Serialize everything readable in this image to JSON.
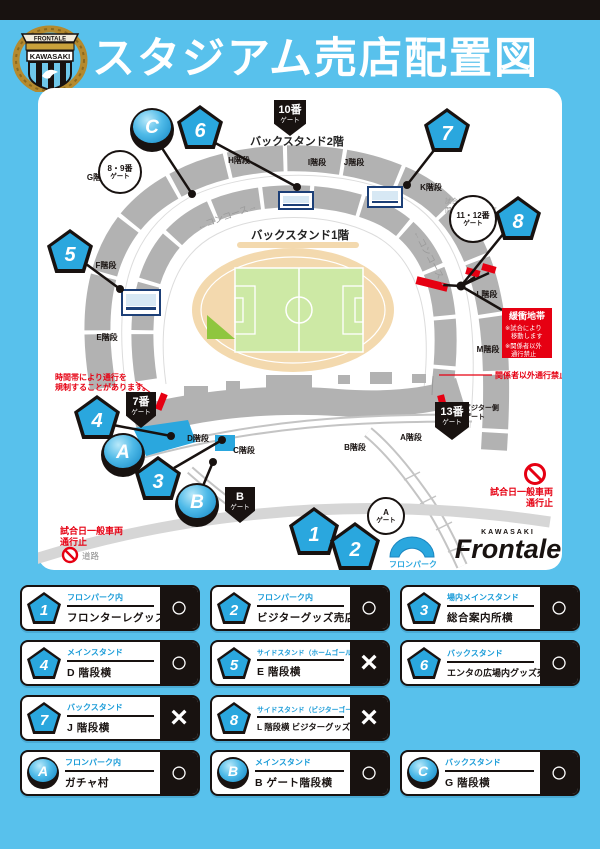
{
  "header": {
    "title": "スタジアム売店配置図",
    "crest": {
      "banner": "FRONTALE",
      "club": "KAWASAKI"
    }
  },
  "map": {
    "stands": {
      "back2f": "バックスタンド2階",
      "back1f": "バックスタンド1階",
      "concourse_left": "←コンコース→",
      "concourse_right": "←コンコース→"
    },
    "sections": {
      "g": "G階段",
      "h": "H階段",
      "i": "I階段",
      "j": "J階段",
      "k": "K階段",
      "f": "F階段",
      "e": "E階段",
      "l": "L階段",
      "m": "M階段",
      "d": "D階段",
      "c": "C階段",
      "b": "B階段",
      "a": "A階段"
    },
    "markers": {
      "p1": "1",
      "p2": "2",
      "p3": "3",
      "p4": "4",
      "p5": "5",
      "p6": "6",
      "p7": "7",
      "p8": "8",
      "a": "A",
      "b": "B",
      "c": "C"
    },
    "gates": {
      "g89": {
        "l1": "8・9番",
        "l2": "ゲート"
      },
      "g10": {
        "l1": "10番",
        "l2": "ゲート"
      },
      "g1112": {
        "l1": "11・12番",
        "l2": "ゲート"
      },
      "g7": {
        "l1": "7番",
        "l2": "ゲート"
      },
      "g13": {
        "l1": "13番",
        "l2": "ゲート"
      },
      "gb": {
        "l1": "B",
        "l2": "ゲート"
      },
      "ga": {
        "l1": "A",
        "l2": "ゲート"
      }
    },
    "visitor_gate": {
      "l1": "ビジター側",
      "l2": "ゲート"
    },
    "buffer": {
      "title": "緩衝地帯",
      "l1": "※試合により",
      "l2": "移動します",
      "l3": "※関係者以外",
      "l4": "通行禁止"
    },
    "notes": {
      "area1": "試合により",
      "area2": "関係者以外エリア",
      "time1": "時間帯により通行を",
      "time2": "規制することがあります。",
      "staff": "関係者以外通行禁止",
      "car1": "試合日一般車両",
      "car2": "通行止",
      "road": "道路"
    },
    "fronpark": "フロンパーク",
    "logo": {
      "kawasaki": "KAWASAKI",
      "frontale": "Frontale"
    }
  },
  "legend": {
    "items": [
      {
        "id": "1",
        "area": "フロンパーク内",
        "name": "フロンターレグッズ売店",
        "mark": "○"
      },
      {
        "id": "2",
        "area": "フロンパーク内",
        "name": "ビジターグッズ売店",
        "mark": "○"
      },
      {
        "id": "3",
        "area": "場内メインスタンド",
        "name": "総合案内所横",
        "mark": "○"
      },
      {
        "id": "4",
        "area": "メインスタンド",
        "name": "D 階段横",
        "mark": "○"
      },
      {
        "id": "5",
        "area": "サイドスタンド（ホームゴール裏）",
        "name": "E 階段横",
        "mark": "×"
      },
      {
        "id": "6",
        "area": "バックスタンド",
        "name": "エンタの広場内グッズ売店",
        "mark": "○"
      },
      {
        "id": "7",
        "area": "バックスタンド",
        "name": "J 階段横",
        "mark": "×"
      },
      {
        "id": "8",
        "area": "サイドスタンド（ビジターゴール裏）",
        "name": "L 階段横 ビジターグッズ売店",
        "mark": "×"
      },
      {
        "id": "A",
        "area": "フロンパーク内",
        "name": "ガチャ村",
        "mark": "○"
      },
      {
        "id": "B",
        "area": "メインスタンド",
        "name": "B ゲート階段横",
        "mark": "○"
      },
      {
        "id": "C",
        "area": "バックスタンド",
        "name": "G 階段横",
        "mark": "○"
      }
    ]
  }
}
